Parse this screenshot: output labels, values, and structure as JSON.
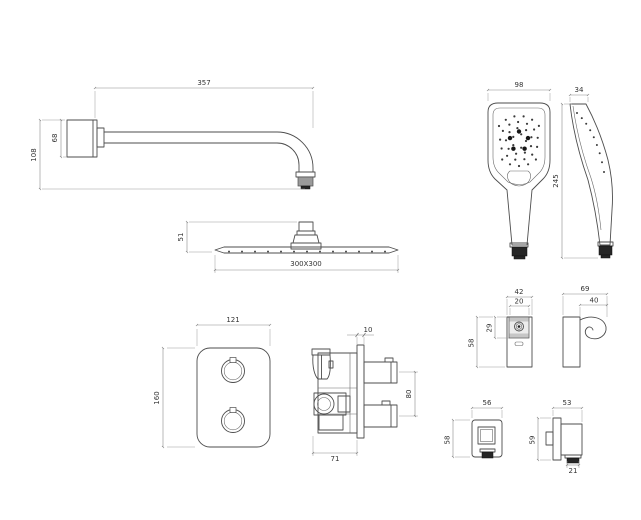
{
  "dims": {
    "arm_length": "357",
    "arm_flange": "68",
    "arm_height": "108",
    "head_thickness": "51",
    "head_size": "300X300",
    "hand_width": "98",
    "hand_depth": "34",
    "hand_height": "245",
    "plate_width": "121",
    "plate_height": "160",
    "valve_plate": "10",
    "valve_ports": "80",
    "valve_depth": "71",
    "bracket_width": "42",
    "bracket_inner_width": "20",
    "bracket_inner_height": "29",
    "bracket_height": "58",
    "bracket_depth": "69",
    "bracket_hook": "40",
    "outlet_width": "56",
    "outlet_height": "58",
    "outlet_depth": "53",
    "outlet_side_height": "59",
    "outlet_spout": "21"
  }
}
